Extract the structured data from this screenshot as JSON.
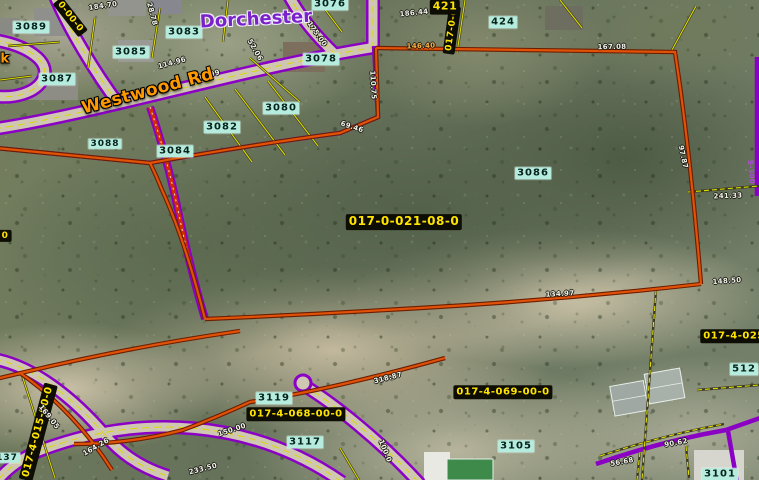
{
  "map": {
    "description": "Aerial GIS parcel map, Dorchester area, Westwood Rd",
    "colors": {
      "parcel_boundary_orange": "#e05207",
      "road_boundary_purple": "#8a00c4",
      "lot_line_yellow": "#dedc00",
      "parcel_id_bg": "#0d0d03",
      "parcel_id_text": "#ffe400",
      "lot_number_bg": "#b5ecdd",
      "street_text": "#ff9900",
      "city_text": "#7a22c9"
    },
    "city_labels": [
      {
        "t": "Dorchester",
        "x": 256,
        "y": 20,
        "r": -3
      }
    ],
    "street_labels": [
      {
        "t": "Westwood Rd",
        "x": 148,
        "y": 92,
        "r": -15
      },
      {
        "t": "k",
        "x": 5,
        "y": 60,
        "r": 0,
        "fs": 13
      }
    ],
    "parcel_ids": [
      {
        "t": "017-0-021-08-0",
        "x": 404,
        "y": 222,
        "r": 0,
        "fs": 12
      },
      {
        "t": "017-4-068-00-0",
        "x": 296,
        "y": 414,
        "r": 0
      },
      {
        "t": "017-4-069-00-0",
        "x": 503,
        "y": 392,
        "r": 0
      },
      {
        "t": "017-4-025",
        "x": 734,
        "y": 336,
        "r": 0
      },
      {
        "t": "017-4-015-00-0",
        "x": 38,
        "y": 432,
        "r": -75
      },
      {
        "t": "0-00-0",
        "x": 70,
        "y": 17,
        "r": 52,
        "fs": 9
      },
      {
        "t": "017-0-0",
        "x": 452,
        "y": 30,
        "r": -82,
        "fs": 9
      },
      {
        "t": "421",
        "x": 445,
        "y": 7,
        "r": 0,
        "fs": 11
      },
      {
        "t": "0",
        "x": 5,
        "y": 236,
        "r": 0,
        "fs": 9
      }
    ],
    "lot_numbers": [
      {
        "t": "3089",
        "x": 31,
        "y": 27
      },
      {
        "t": "3083",
        "x": 184,
        "y": 32
      },
      {
        "t": "3085",
        "x": 131,
        "y": 52
      },
      {
        "t": "3087",
        "x": 57,
        "y": 79
      },
      {
        "t": "3088",
        "x": 105,
        "y": 144,
        "fs": 9
      },
      {
        "t": "3084",
        "x": 175,
        "y": 151
      },
      {
        "t": "3082",
        "x": 222,
        "y": 127
      },
      {
        "t": "3080",
        "x": 281,
        "y": 108
      },
      {
        "t": "3078",
        "x": 321,
        "y": 59
      },
      {
        "t": "3076",
        "x": 330,
        "y": 4
      },
      {
        "t": "424",
        "x": 503,
        "y": 22
      },
      {
        "t": "3086",
        "x": 533,
        "y": 173
      },
      {
        "t": "512",
        "x": 744,
        "y": 369
      },
      {
        "t": "3119",
        "x": 274,
        "y": 398
      },
      {
        "t": "3117",
        "x": 305,
        "y": 442
      },
      {
        "t": "3105",
        "x": 516,
        "y": 446
      },
      {
        "t": "3101",
        "x": 720,
        "y": 474
      },
      {
        "t": "137",
        "x": 7,
        "y": 458,
        "fs": 9
      }
    ],
    "dimensions": [
      {
        "t": "146.40",
        "x": 421,
        "y": 46,
        "r": -2,
        "cls": "orange"
      },
      {
        "t": "114.96",
        "x": 172,
        "y": 63,
        "r": -15
      },
      {
        "t": "109.99",
        "x": 206,
        "y": 76,
        "r": -15
      },
      {
        "t": "184.70",
        "x": 103,
        "y": 6,
        "r": -8
      },
      {
        "t": "28.78",
        "x": 152,
        "y": 14,
        "r": 75
      },
      {
        "t": "175.00",
        "x": 317,
        "y": 34,
        "r": 55
      },
      {
        "t": "186.44",
        "x": 414,
        "y": 13,
        "r": -6
      },
      {
        "t": "167.08",
        "x": 612,
        "y": 47,
        "r": -1
      },
      {
        "t": "97.87",
        "x": 683,
        "y": 157,
        "r": 78
      },
      {
        "t": "110.75",
        "x": 373,
        "y": 85,
        "r": 87
      },
      {
        "t": "69.46",
        "x": 352,
        "y": 127,
        "r": 18
      },
      {
        "t": "241.33",
        "x": 728,
        "y": 196,
        "r": -2
      },
      {
        "t": "134.97",
        "x": 560,
        "y": 294,
        "r": -3
      },
      {
        "t": "148.50",
        "x": 727,
        "y": 281,
        "r": -4
      },
      {
        "t": "318.87",
        "x": 388,
        "y": 378,
        "r": -14
      },
      {
        "t": "169.05",
        "x": 49,
        "y": 417,
        "r": 52
      },
      {
        "t": "164.26",
        "x": 96,
        "y": 447,
        "r": -30
      },
      {
        "t": "233.50",
        "x": 203,
        "y": 469,
        "r": -14
      },
      {
        "t": "150.00",
        "x": 232,
        "y": 430,
        "r": -18
      },
      {
        "t": "100.0",
        "x": 385,
        "y": 451,
        "r": 68
      },
      {
        "t": "90.62",
        "x": 676,
        "y": 443,
        "r": -10
      },
      {
        "t": "56.68",
        "x": 622,
        "y": 462,
        "r": -10
      },
      {
        "t": "52.06",
        "x": 255,
        "y": 50,
        "r": 60
      },
      {
        "t": "S-300",
        "x": 751,
        "y": 172,
        "r": 85,
        "cls": "purpledim"
      }
    ]
  }
}
